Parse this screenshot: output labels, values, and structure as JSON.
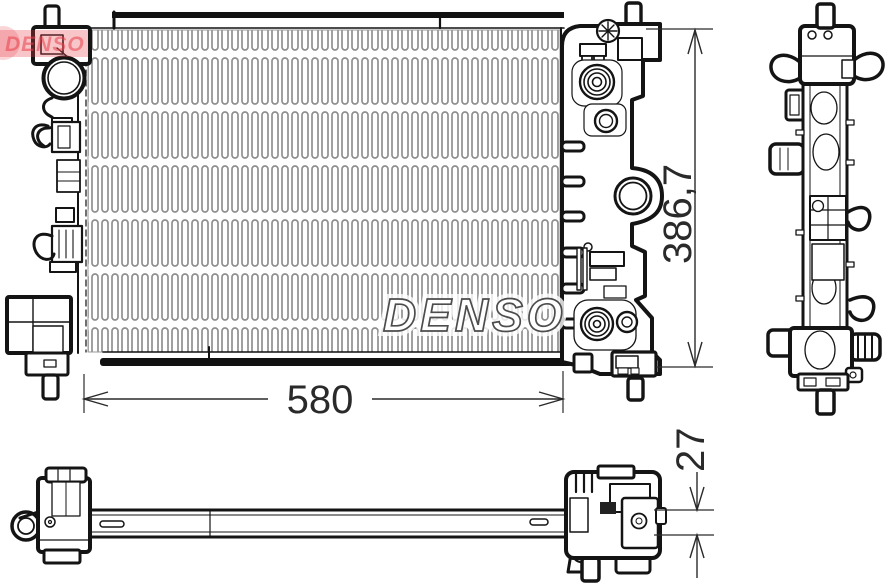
{
  "part_drawing": {
    "watermark_text": "DENSO",
    "stamp_text": "DENSO",
    "dimensions": {
      "core_width": "580",
      "overall_height": "386,7",
      "core_depth": "27"
    },
    "colors": {
      "line": "#141414",
      "fin_gray": "#8f8f8f",
      "stamp_red": "#e73f4a",
      "dim_text": "#2a2a2a"
    }
  }
}
